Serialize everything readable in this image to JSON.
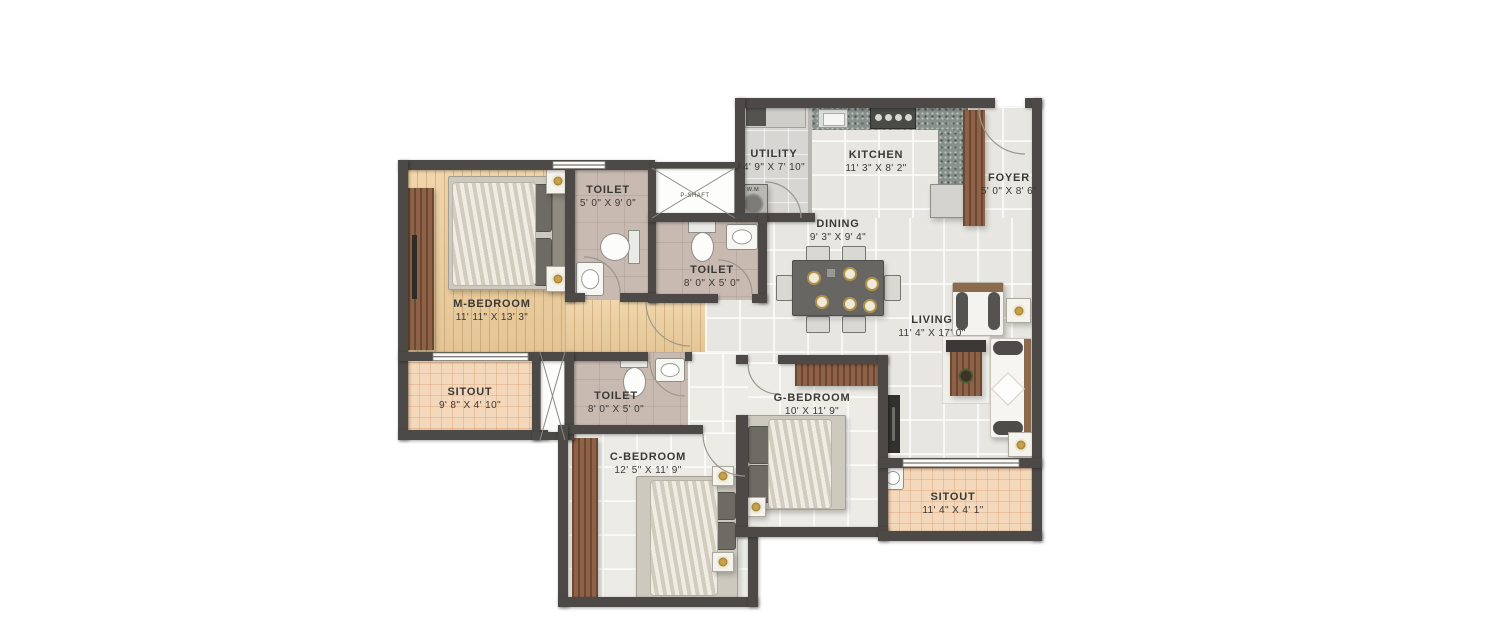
{
  "plan_title": "2BHK-style residential floor plan",
  "colors": {
    "wall": "#4c4946",
    "wood_floor": "#ecd0a2",
    "tile_floor": "#e7e6e0",
    "toilet_floor": "#c8bab0",
    "sitout_floor": "#f4d8bb",
    "wood_panel": "#8d6248",
    "granite_counter": "#87908a",
    "label_text": "#3a3936"
  },
  "rooms": {
    "m_bedroom": {
      "name": "M-BEDROOM",
      "dims": "11' 11\" X 13' 3\""
    },
    "toilet_m": {
      "name": "TOILET",
      "dims": "5' 0\" X 9' 0\""
    },
    "toilet_mid": {
      "name": "TOILET",
      "dims": "8' 0\" X 5' 0\""
    },
    "toilet_c": {
      "name": "TOILET",
      "dims": "8' 0\" X 5' 0\""
    },
    "utility": {
      "name": "UTILITY",
      "dims": "4' 9\" X 7' 10\""
    },
    "kitchen": {
      "name": "KITCHEN",
      "dims": "11' 3\" X 8' 2\""
    },
    "foyer": {
      "name": "FOYER",
      "dims": "5' 0\" X 8' 6\""
    },
    "dining": {
      "name": "DINING",
      "dims": "9' 3\" X 9' 4\""
    },
    "living": {
      "name": "LIVING",
      "dims": "11' 4\" X 17' 0\""
    },
    "sitout_left": {
      "name": "SITOUT",
      "dims": "9' 8\" X 4' 10\""
    },
    "sitout_right": {
      "name": "SITOUT",
      "dims": "11' 4\" X 4' 1\""
    },
    "c_bedroom": {
      "name": "C-BEDROOM",
      "dims": "12' 5\" X 11' 9\""
    },
    "g_bedroom": {
      "name": "G-BEDROOM",
      "dims": "10' X 11' 9\""
    }
  },
  "small_labels": {
    "shaft": "P-SHAFT",
    "washing_machine": "W.M"
  }
}
